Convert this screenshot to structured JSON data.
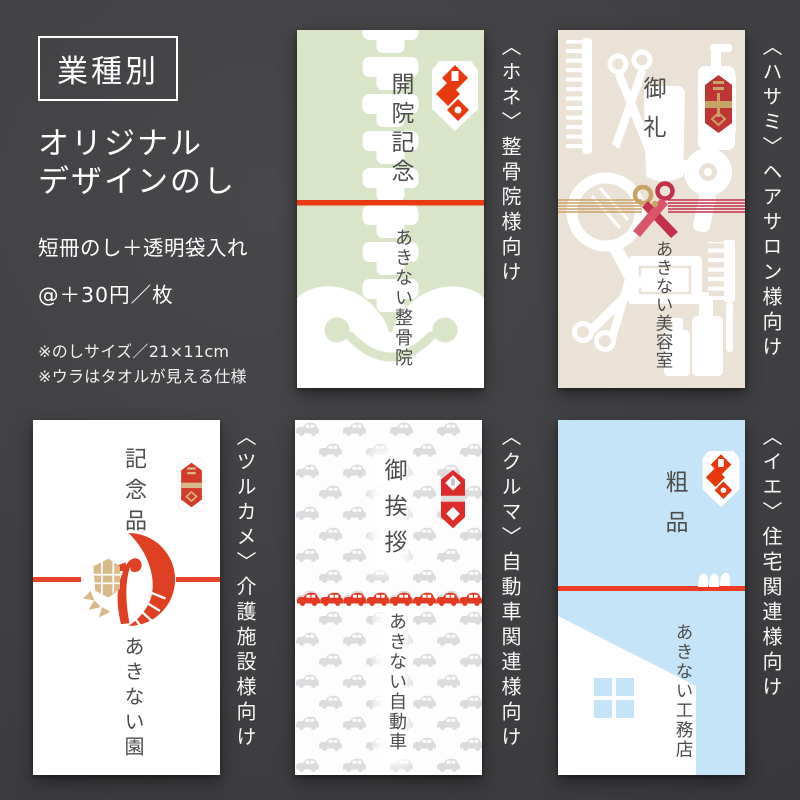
{
  "intro": {
    "badge": "業種別",
    "heading_line1": "オリジナル",
    "heading_line2": "デザインのし",
    "product_type": "短冊のし＋透明袋入れ",
    "unit_price": "@＋30円／枚",
    "note_size": "※のしサイズ／21×11cm",
    "note_back": "※ウラはタオルが見える仕様"
  },
  "cards": [
    {
      "id": "hone",
      "audience_label": "〈ホネ〉整骨院様向け",
      "title": "開院記念",
      "giver_name": "あきない整骨院",
      "bg_color": "#d9e4c8"
    },
    {
      "id": "hasami",
      "audience_label": "〈ハサミ〉ヘアサロン様向け",
      "title": "御礼",
      "giver_name": "あきない美容室",
      "bg_color": "#eae2d6"
    },
    {
      "id": "tsurukame",
      "audience_label": "〈ツルカメ〉介護施設様向け",
      "title": "記念品",
      "giver_name": "あきない園",
      "bg_color": "#ffffff"
    },
    {
      "id": "kuruma",
      "audience_label": "〈クルマ〉自動車関連様向け",
      "title": "御挨拶",
      "giver_name": "あきない自動車",
      "bg_color": "#ffffff"
    },
    {
      "id": "ie",
      "audience_label": "〈イエ〉住宅関連様向け",
      "title": "粗品",
      "giver_name": "あきない工務店",
      "bg_color": "#c6e4f7"
    }
  ],
  "icons": {
    "noshi_white_red": "noshi-ornament-red-diamonds",
    "noshi_red_gold": "noshi-ornament-red-gold",
    "noshi_red_gray": "noshi-ornament-red-gray",
    "spine": "spine-bones",
    "pelvis": "pelvis-smile",
    "salon_tools": "salon-tools",
    "mizuhiki_knot": "mizuhiki-scissors-knot",
    "crane_turtle": "crane-turtle-circle",
    "car_pattern": "car-pattern",
    "house": "house-silhouette",
    "birds": "birds-on-wire"
  },
  "colors": {
    "background": "#3e3e41",
    "text_on_dark": "#ffffff",
    "card_text": "#4d4d4d",
    "accent_red": "#ea3a14",
    "mizuhiki_red": "#c2304a",
    "mizuhiki_gold": "#c9a268",
    "bone_card_green": "#d9e4c8",
    "salon_card_beige": "#eae2d6",
    "house_card_blue": "#c6e4f7",
    "car_pattern_gray": "#dcdcde",
    "car_red": "#e23a23",
    "crane_red": "#df3f22",
    "turtle_gold": "#d9b98a"
  }
}
